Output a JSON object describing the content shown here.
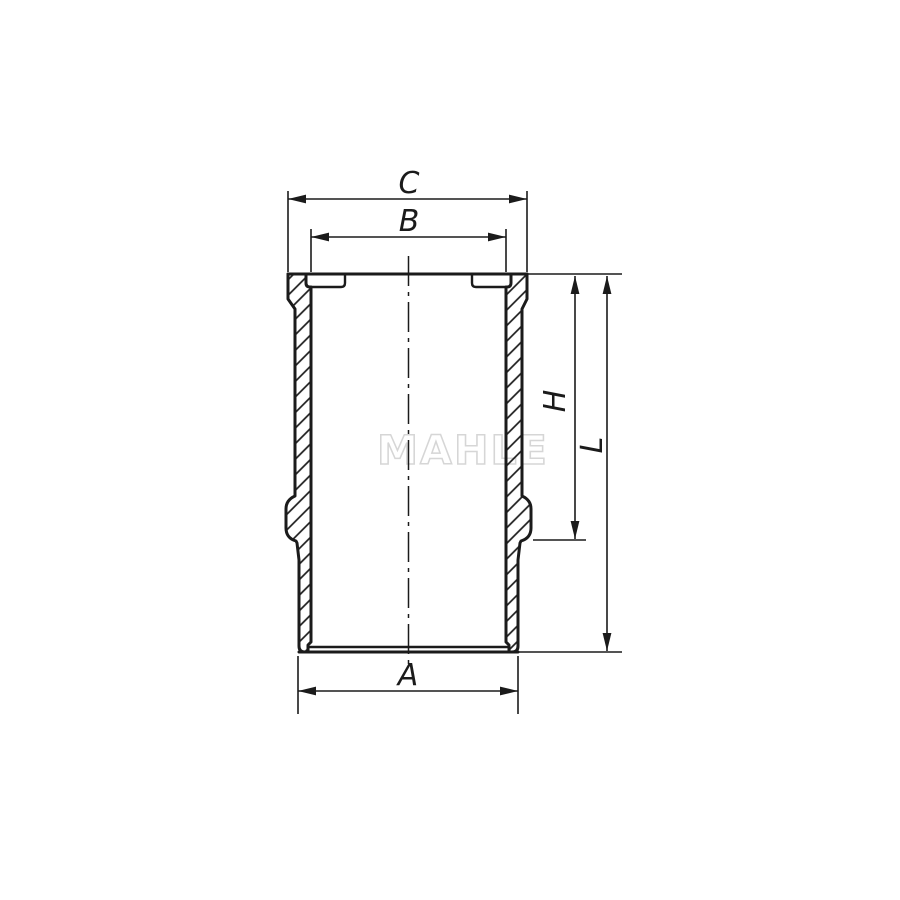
{
  "drawing": {
    "watermark": "MAHLE",
    "dimension_labels": {
      "c": "C",
      "b": "B",
      "a": "A",
      "h": "H",
      "l": "L"
    },
    "colors": {
      "line": "#1b1b1b",
      "watermark": "#d6d6d6",
      "background": "#ffffff"
    }
  }
}
